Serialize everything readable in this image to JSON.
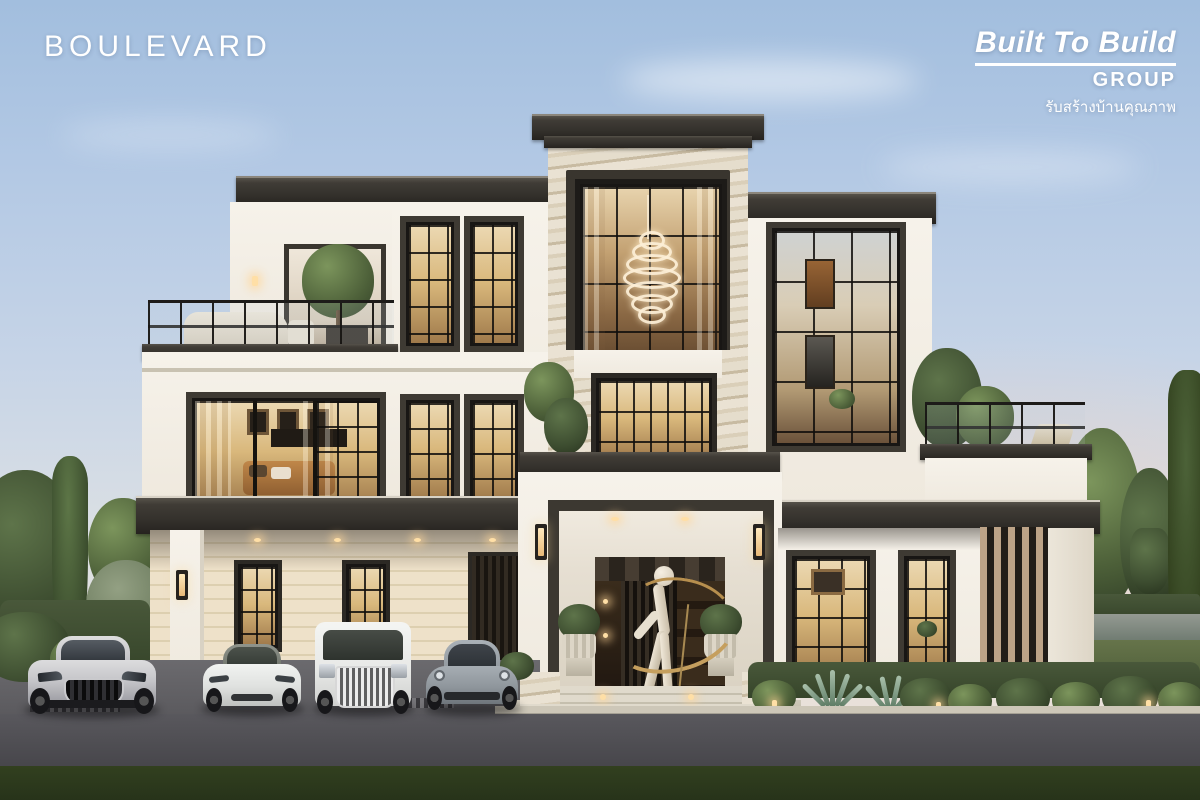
{
  "overlay": {
    "project_title": "BOULEVARD",
    "brand": {
      "name": "Built To Build",
      "group": "GROUP",
      "tagline_thai": "รับสร้างบ้านคุณภาพ"
    }
  },
  "scene": {
    "setting": "Architectural render of a three-storey modern-classic luxury house at dusk, front elevation",
    "house": {
      "style": "white stucco walls, dark charcoal cornices and trim, marble-clad central tower",
      "features": [
        "spiral chandelier in double-height tower window",
        "roof terrace with tree and sofa (left)",
        "roof terrace with trees and lounger (right)",
        "carport with four cars",
        "entrance portico with abstract gold-ribbon statue",
        "classical urn planters",
        "warm-lit black-framed windows",
        "vertical bronze slat feature wall"
      ]
    },
    "vehicles": [
      "silver sports sedan",
      "white electric sedan",
      "white luxury MPV",
      "grey sports coupe"
    ],
    "landscape": [
      "clipped round hedges",
      "agave plants",
      "cypress tree",
      "lawn and lake on right",
      "asphalt road",
      "grass verge"
    ],
    "colors": {
      "sky_top": "#a2bede",
      "sky_horizon_warm": "#ece3da",
      "wall_white": "#f2ede4",
      "trim_charcoal": "#34312c",
      "marble_beige": "#e0d6c2",
      "window_glow": "#d9b87c",
      "cream_siding": "#eee1c9",
      "greenery": "#4d6039",
      "road_asphalt": "#535258",
      "grass_verge": "#2d3a21",
      "gold_accent": "#c59f5e"
    }
  }
}
